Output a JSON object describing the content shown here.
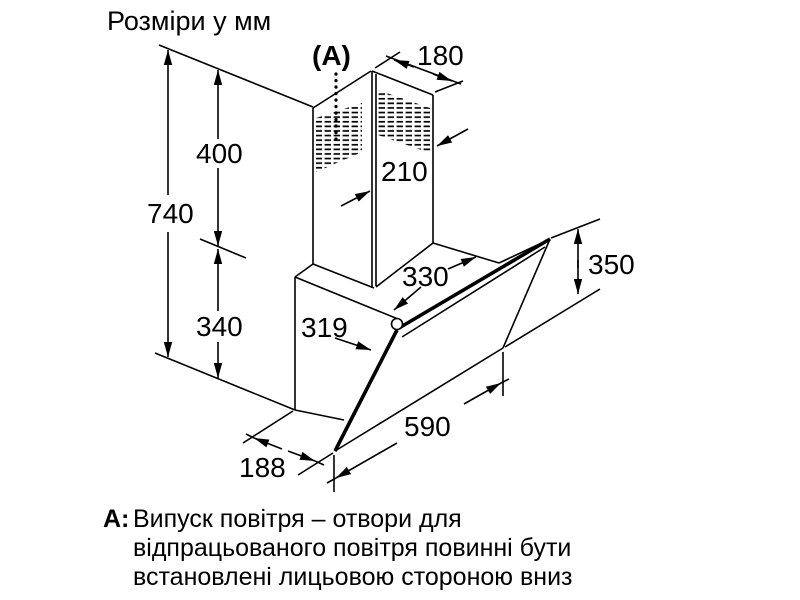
{
  "title": "Розміри у мм",
  "diagram": {
    "callout_label": "(A)",
    "dimensions": {
      "total_height": "740",
      "upper_height": "400",
      "lower_height": "340",
      "chimney_depth": "180",
      "chimney_width": "210",
      "top_depth": "330",
      "mid_depth": "319",
      "front_panel_height": "350",
      "front_panel_width": "590",
      "bottom_wall_offset": "188"
    }
  },
  "note": {
    "prefix": "A:",
    "lines": [
      "Випуск повітря – отвори для",
      "відпрацьованого повітря повинні бути",
      "встановлені лицьовою стороною вниз"
    ]
  },
  "colors": {
    "line": "#000000",
    "background": "#ffffff"
  }
}
